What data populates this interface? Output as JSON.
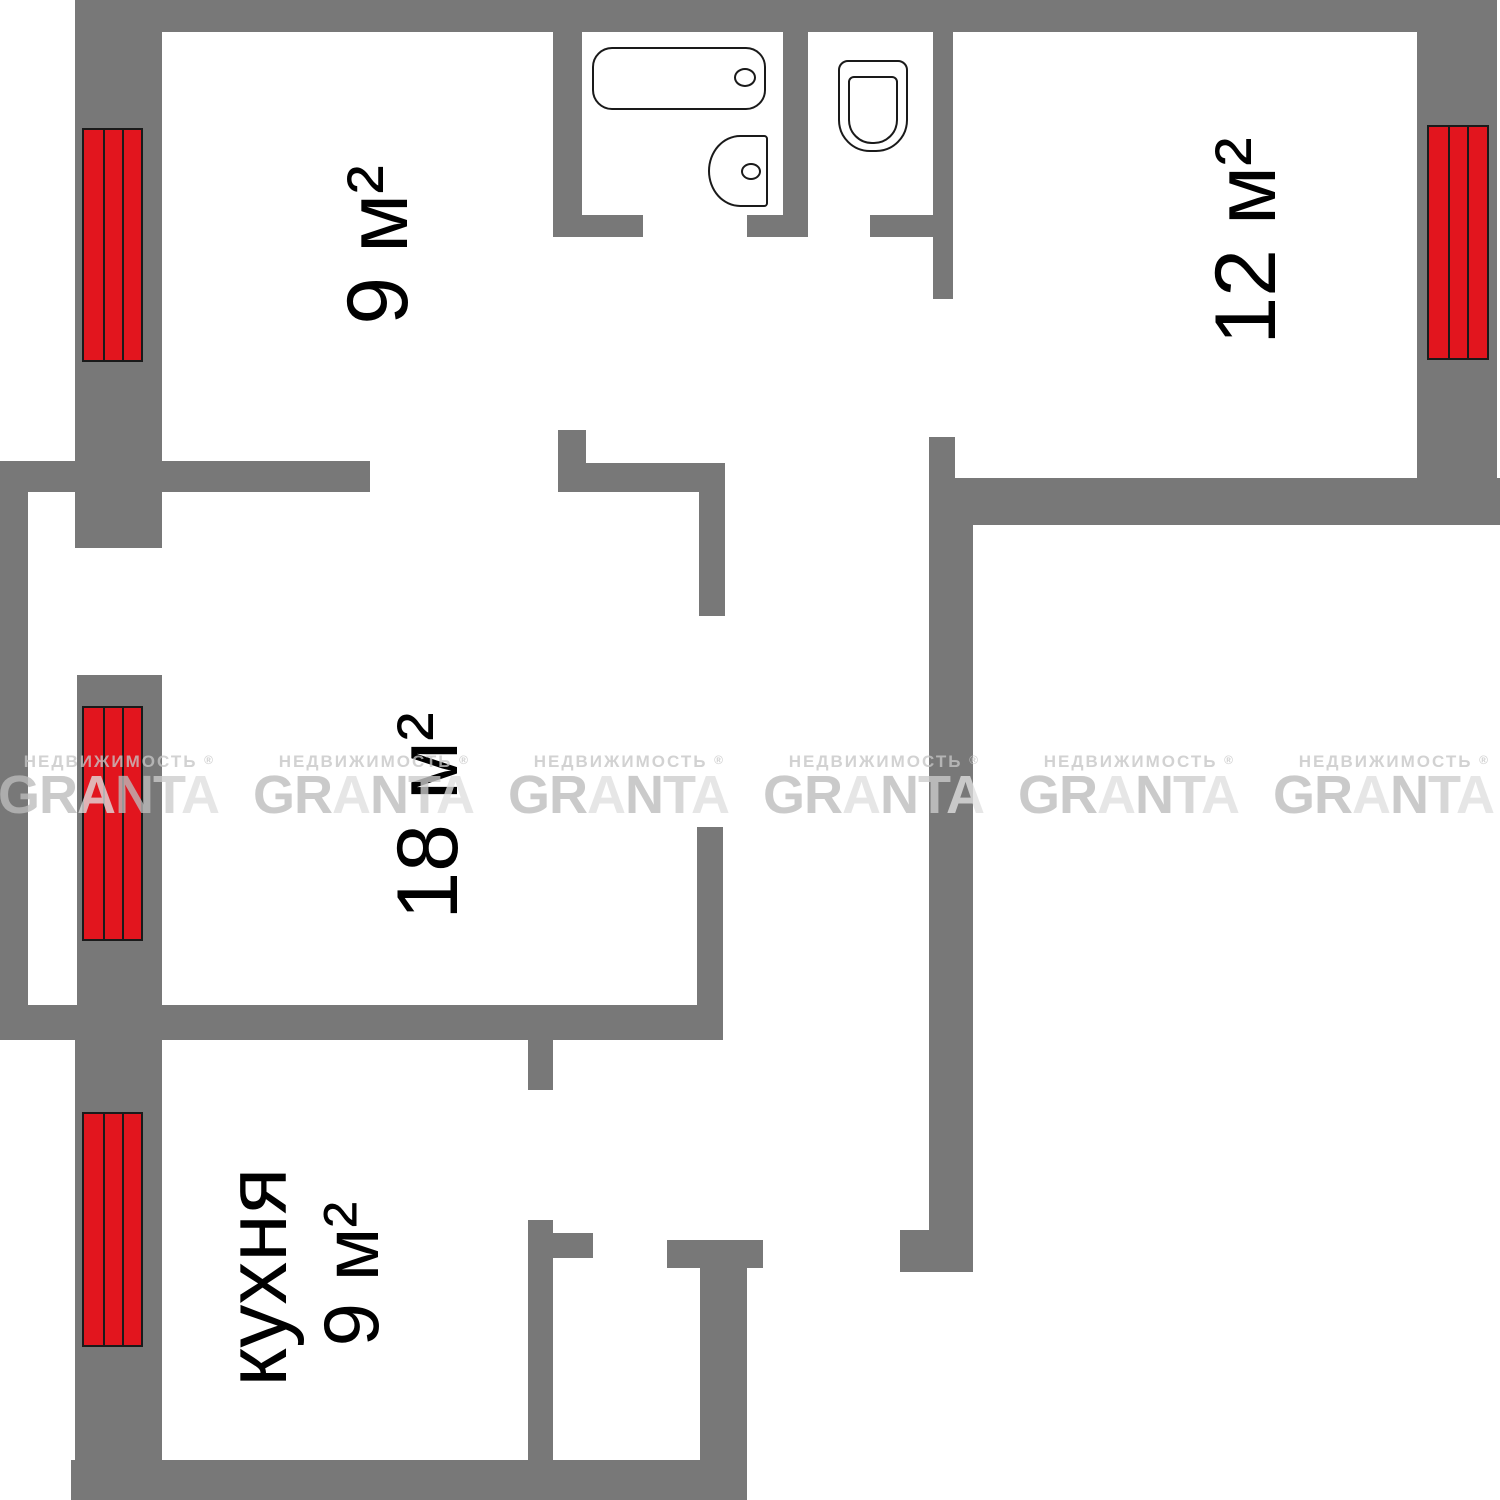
{
  "plan": {
    "rooms": [
      {
        "name": "room-top-left",
        "label": "9 м²"
      },
      {
        "name": "room-top-right",
        "label": "12 м²"
      },
      {
        "name": "room-living",
        "label": "18 м²"
      },
      {
        "name": "kitchen",
        "label": "кухня",
        "area": "9 м²"
      }
    ],
    "fixtures": [
      {
        "name": "bathtub"
      },
      {
        "name": "sink"
      },
      {
        "name": "toilet"
      }
    ],
    "radiator_count": 4
  },
  "watermark": {
    "tagline": "НЕДВИЖИМОСТЬ",
    "reg": "®",
    "brand": "GRANTA",
    "count": 6,
    "letter_shades": [
      "#bcbcbc",
      "#bcbcbc",
      "#e0e0e0",
      "#bcbcbc",
      "#cccccc",
      "#e0e0e0"
    ]
  },
  "colors": {
    "background": "#ffffff",
    "wall": "#787878",
    "radiator": "#e2151e",
    "line": "#1a1a1a",
    "label": "#000000",
    "watermark_tagline": "#c6c6c6"
  }
}
